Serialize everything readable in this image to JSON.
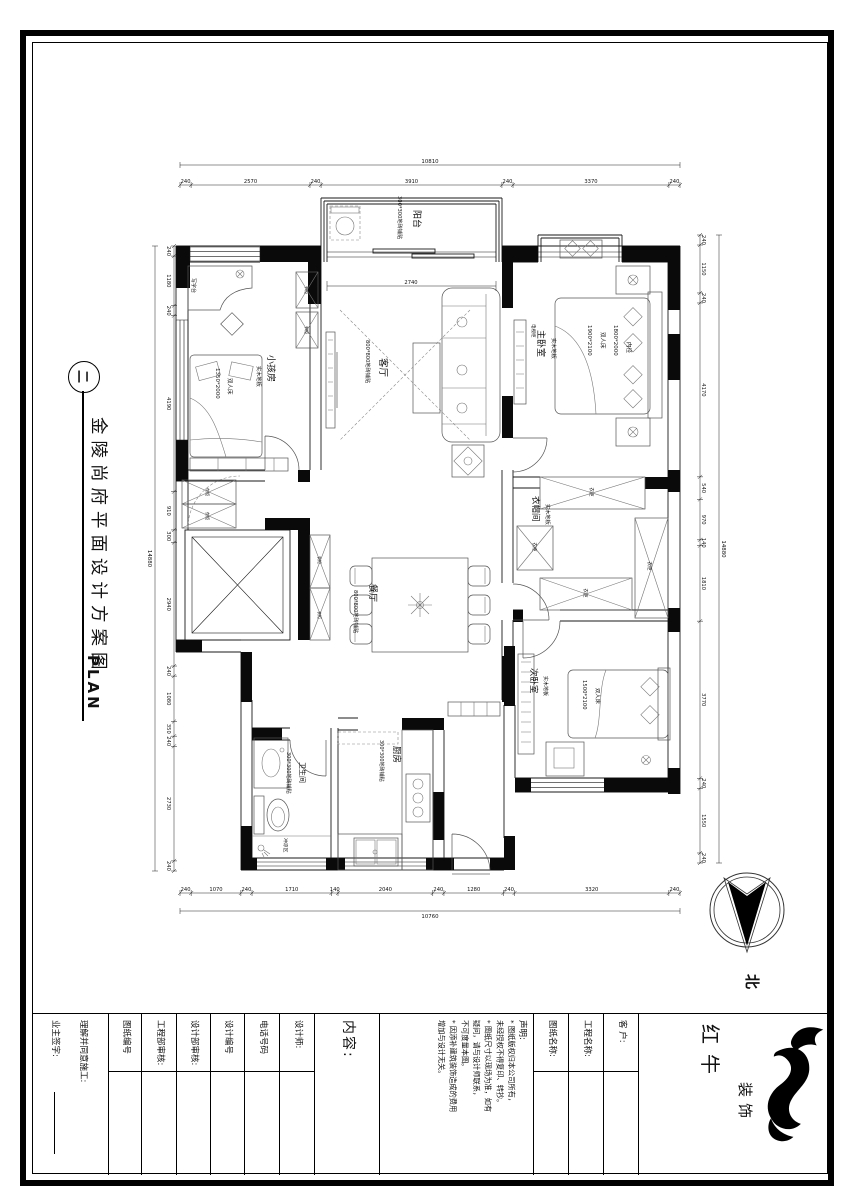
{
  "sheet": {
    "title_vertical": "金陵尚府平面设计方案图",
    "title_sub": "PLAN",
    "title_index": "二",
    "compass_label": "北"
  },
  "plan": {
    "rooms": {
      "balcony": {
        "name": "阳台",
        "floor": "300*300地砖铺贴"
      },
      "living": {
        "name": "客厅",
        "floor": "800*800地砖铺贴"
      },
      "kids": {
        "name": "小孩房",
        "floor": "实木地板"
      },
      "master": {
        "name": "主卧室",
        "floor": "实木地板"
      },
      "cloak": {
        "name": "衣帽间",
        "floor": "实木地板"
      },
      "second": {
        "name": "次卧室",
        "floor": "实木地板"
      },
      "dining": {
        "name": "餐厅",
        "floor": "800*800地砖铺贴"
      },
      "bath": {
        "name": "卫生间",
        "floor": "300*300地砖铺贴"
      },
      "kitchen": {
        "name": "厨房",
        "floor": "300*300地砖铺贴"
      },
      "shower": "冲凉区"
    },
    "furniture": {
      "desk": "写字台",
      "bookcase": "书柜",
      "wardrobe": "衣柜",
      "tv_cabinet": "电视柜",
      "kids_bed": [
        "1350*2000",
        "双人床"
      ],
      "master_bed": [
        "1900*2100",
        "双人床",
        "1800*2000",
        "内径"
      ],
      "second_bed": [
        "1500*2100",
        "双人床"
      ]
    },
    "inner_dims": {
      "balcony_door": "2740"
    },
    "dims": {
      "top": {
        "total": 10810,
        "segments": [
          240,
          2570,
          240,
          3910,
          240,
          3370,
          240
        ]
      },
      "bottom": {
        "total": 10760,
        "segments": [
          240,
          1070,
          240,
          1710,
          140,
          2040,
          240,
          1280,
          240,
          3320,
          240
        ]
      },
      "left": {
        "total": 14880,
        "segments": [
          240,
          1180,
          240,
          4190,
          910,
          300,
          2940,
          240,
          1080,
          350,
          240,
          2730,
          240
        ]
      },
      "right": {
        "total": 14880,
        "segments": [
          240,
          1150,
          240,
          4170,
          540,
          970,
          140,
          1810,
          3770,
          240,
          1550,
          240
        ]
      }
    }
  },
  "titleblock": {
    "cells": [
      {
        "label": "理解并同意施工:",
        "label2": "业主签字:"
      },
      {
        "label": "图纸编号"
      },
      {
        "label": "工程部审核:"
      },
      {
        "label": "设计部审核:"
      },
      {
        "label": "设计编号"
      },
      {
        "label": "电话号码"
      },
      {
        "label": "设计师:"
      },
      {
        "label": "内容:"
      },
      {
        "label": "声明:",
        "lines": [
          "* 图纸版权归本公司所有，",
          "  未经授权不得复印、转抄。",
          "* 图纸尺寸以现场为准，如有",
          "  疑问，请与设计师联系，",
          "  不可度量本图。",
          "* 因添补建筑装饰造成的费用",
          "  增加与设计无关。"
        ]
      },
      {
        "label": "图纸名称:"
      },
      {
        "label": "工程名称:"
      },
      {
        "label": "客 户:"
      },
      {
        "label": "红牛",
        "label2": "装饰"
      }
    ]
  }
}
